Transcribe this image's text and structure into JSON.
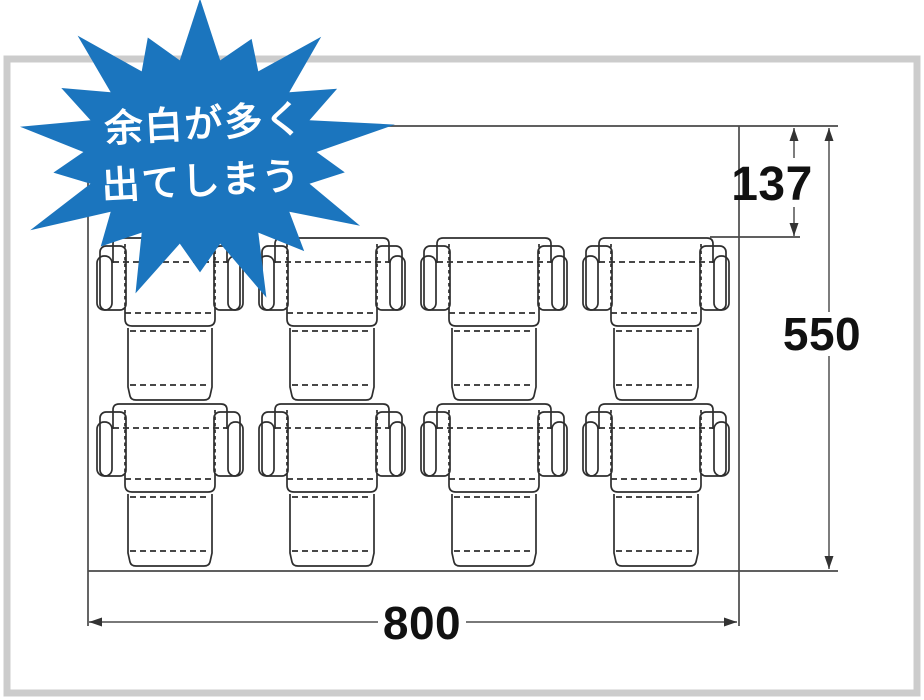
{
  "illustration": {
    "description": "Packaging imposition diagram: many box dielines on a sheet leaving excess margin"
  },
  "colors": {
    "accent_blue": "#1b75be",
    "frame_gray": "#cccccc",
    "cut_line": "#2e2e2e",
    "sheet_line": "#4a4a4a",
    "dimension_line": "#666666"
  },
  "badge": {
    "text_lines": [
      "余白が多く",
      "出てしまう"
    ]
  },
  "sheet": {
    "width_label": "800",
    "height_label": "550",
    "top_margin_label": "137",
    "grid": {
      "rows": 2,
      "cols": 4,
      "total_dielines": 8
    }
  }
}
